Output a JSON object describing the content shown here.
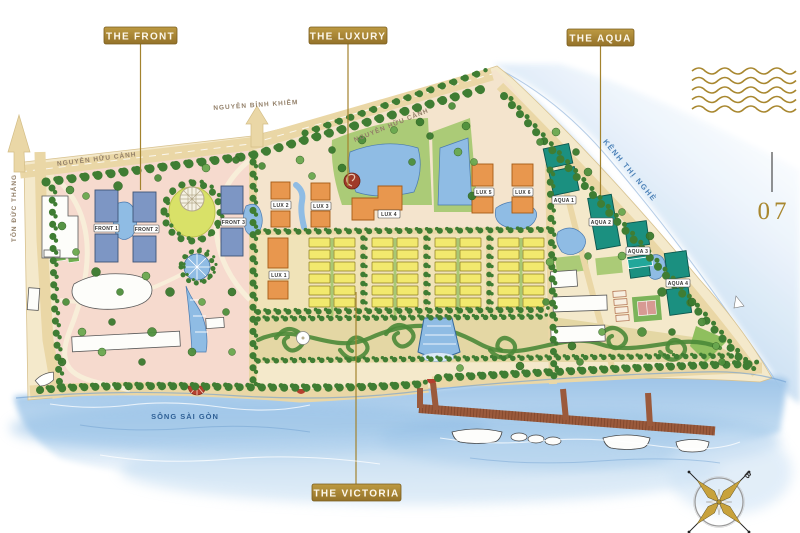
{
  "page": {
    "number": "07",
    "compass_north": "B"
  },
  "zones": {
    "front": {
      "badge": "THE FRONT"
    },
    "luxury": {
      "badge": "THE LUXURY"
    },
    "aqua": {
      "badge": "THE AQUA"
    },
    "victoria": {
      "badge": "THE VICTORIA"
    }
  },
  "building_labels": {
    "front": [
      "FRONT 1",
      "FRONT 2",
      "FRONT 3"
    ],
    "lux": [
      "LUX 1",
      "LUX 2",
      "LUX 3",
      "LUX 4",
      "LUX 5",
      "LUX 6"
    ],
    "aqua": [
      "AQUA 1",
      "AQUA 2",
      "AQUA 3",
      "AQUA 4"
    ]
  },
  "streets": {
    "ton_duc_thang": "TÔN ĐỨC THẮNG",
    "nguyen_huu_canh_west": "NGUYỄN HỮU CẢNH",
    "nguyen_binh_khiem": "NGUYỄN BỈNH KHIÊM",
    "nguyen_huu_canh_north": "NGUYỄN HỮU CẢNH"
  },
  "waterways": {
    "river": "SÔNG SÀI GÒN",
    "canal": "KÊNH THỊ NGHÈ"
  },
  "colors": {
    "badge_gold": "#a8862f",
    "front_blue": "#7d96c4",
    "lux_orange": "#e8974e",
    "aqua_teal": "#1b9080",
    "victoria_yellow": "#f2e96e",
    "water_blue": "#9cc3e8",
    "land_sand": "#f4e9cb",
    "front_pink": "#f6d9ce"
  }
}
